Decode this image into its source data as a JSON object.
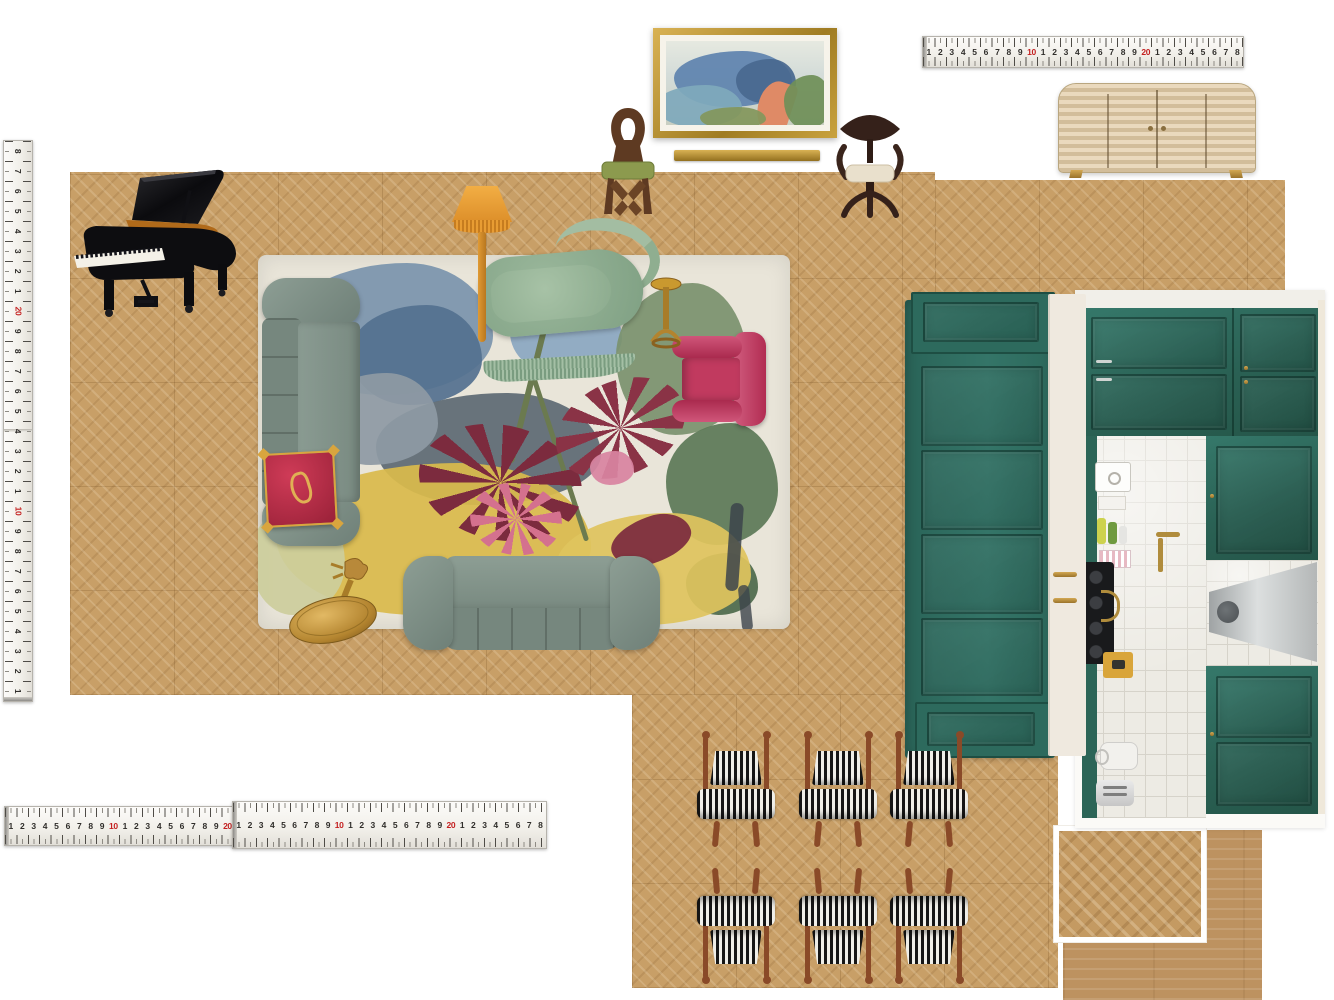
{
  "board": {
    "type": "interior-design-floorplan-moodboard",
    "background_color": "#ffffff",
    "floor_finishes": {
      "parquet_chevron": "#c89f67",
      "plank_oak": "#bd9260"
    }
  },
  "rulers": {
    "tape_color": "#f4f2ec",
    "number_color": "#2f2d2a",
    "ten_marker_color": "#c42020",
    "top_right": {
      "numbers": [
        "1",
        "2",
        "3",
        "4",
        "5",
        "6",
        "7",
        "8",
        "9",
        "10",
        "1",
        "2",
        "3",
        "4",
        "5",
        "6",
        "7",
        "8",
        "9",
        "20",
        "1",
        "2",
        "3",
        "4",
        "5",
        "6",
        "7",
        "8"
      ]
    },
    "bottom_left": {
      "numbers": [
        "1",
        "2",
        "3",
        "4",
        "5",
        "6",
        "7",
        "8",
        "9",
        "10",
        "1",
        "2",
        "3",
        "4",
        "5",
        "6",
        "7",
        "8",
        "9",
        "20"
      ]
    },
    "bottom_right": {
      "numbers": [
        "1",
        "2",
        "3",
        "4",
        "5",
        "6",
        "7",
        "8",
        "9",
        "10",
        "1",
        "2",
        "3",
        "4",
        "5",
        "6",
        "7",
        "8",
        "9",
        "20",
        "1",
        "2",
        "3",
        "4",
        "5",
        "6",
        "7",
        "8"
      ]
    },
    "left_vertical": {
      "numbers": [
        "1",
        "2",
        "3",
        "4",
        "5",
        "6",
        "7",
        "8",
        "9",
        "10",
        "1",
        "2",
        "3",
        "4",
        "5",
        "6",
        "7",
        "8",
        "9",
        "20",
        "1",
        "2",
        "3",
        "4",
        "5",
        "6",
        "7",
        "8"
      ]
    }
  },
  "dining_chairs": {
    "count": 6,
    "wood_color": "#8a4a28",
    "stripe_dark": "#161616",
    "stripe_light": "#f0efe9",
    "cols_x": [
      695,
      797,
      888
    ],
    "rows": [
      {
        "y": 733,
        "flipped": false
      },
      {
        "y": 868,
        "flipped": true
      }
    ],
    "width": 82,
    "height": 114
  },
  "kitchen": {
    "cabinet_color": "#2e6a5c",
    "island_color": "#2f7163",
    "counter_color": "#efe9df",
    "tile_color": "#edebe4",
    "hood_finish": "stainless",
    "hardware_color": "#b08c3c"
  },
  "inventory": [
    {
      "item": "grand-piano",
      "finish": "polished-black",
      "count": 1
    },
    {
      "item": "wall-art-landscape",
      "frame": "gold",
      "count": 1
    },
    {
      "item": "frame-moulding-strip",
      "finish": "gold",
      "count": 1
    },
    {
      "item": "bentwood-loop-chair",
      "seat_color": "olive-green",
      "count": 1
    },
    {
      "item": "sculpted-wood-armchair",
      "seat_color": "cream",
      "count": 1
    },
    {
      "item": "striped-credenza",
      "finish": "bone-inlay",
      "count": 1
    },
    {
      "item": "fringed-floor-lamp",
      "shade_color": "#e09a33",
      "count": 1
    },
    {
      "item": "floral-area-rug",
      "base_color": "#e9e5d9",
      "count": 1
    },
    {
      "item": "velvet-sofa",
      "color": "#7d8e85",
      "count": 2
    },
    {
      "item": "fringed-chaise-longue",
      "color": "#8fac92",
      "count": 1
    },
    {
      "item": "velvet-armchair",
      "color": "#c13a5f",
      "count": 1
    },
    {
      "item": "tasselled-cushion",
      "color": "#c5314e",
      "count": 1
    },
    {
      "item": "brass-pedestal-side-table",
      "count": 1
    },
    {
      "item": "brass-martini-table",
      "count": 1
    },
    {
      "item": "kitchen-island",
      "color": "#2f7163",
      "count": 1
    },
    {
      "item": "kitchen-cabinetry-run",
      "color": "#2e6a5c",
      "count": 1
    },
    {
      "item": "striped-dining-chair",
      "count": 6
    },
    {
      "item": "herringbone-floor-swatch",
      "count": 1
    },
    {
      "item": "plank-floor-swatch",
      "count": 1
    },
    {
      "item": "measuring-tape",
      "count": 4
    }
  ]
}
